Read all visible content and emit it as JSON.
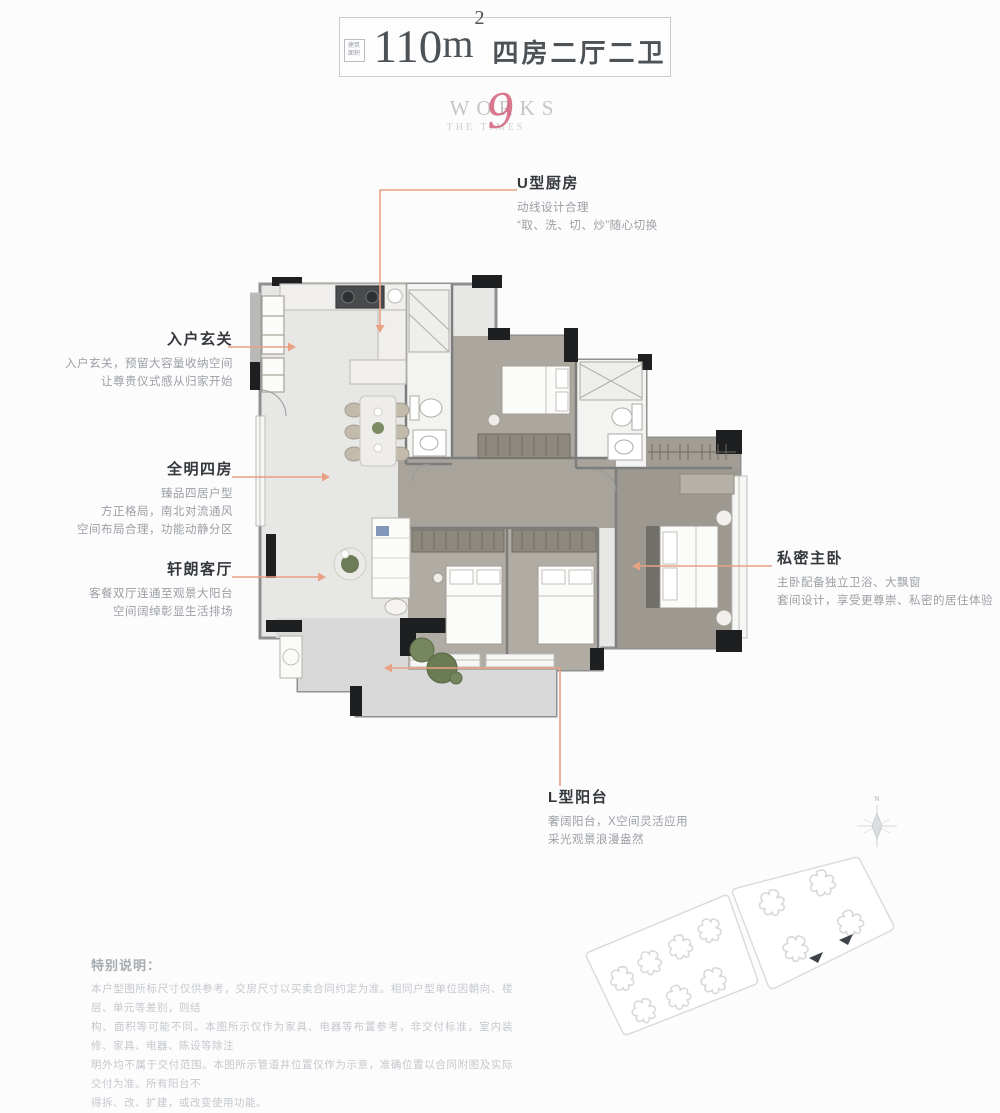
{
  "palette": {
    "leader_accent": "#e8a184",
    "logo_accent": "#d2637c",
    "title_text": "#4d5257",
    "label_title": "#34383c",
    "label_body": "#9b9fa4",
    "wall_dark": "#1e1f20",
    "floor_main": "#e7e7e6",
    "floor_wood": "#a8a49b",
    "note_text": "#c4c8cc"
  },
  "header": {
    "stamp_line1": "建筑",
    "stamp_line2": "面积",
    "area_value": "110",
    "area_unit": "m",
    "area_sup": "2",
    "layout_text": "四房二厅二卫"
  },
  "logo": {
    "line1": "WORKS",
    "script": "9",
    "line2": "THE TIMES"
  },
  "callouts": [
    {
      "id": "u-kitchen",
      "title": "U型厨房",
      "lines": [
        "动线设计合理",
        "“取、洗、切、炒”随心切换"
      ]
    },
    {
      "id": "entry-foyer",
      "title": "入户玄关",
      "lines": [
        "入户玄关，预留大容量收纳空间",
        "让尊贵仪式感从归家开始"
      ]
    },
    {
      "id": "bright-four-rooms",
      "title": "全明四房",
      "lines": [
        "臻品四居户型",
        "方正格局，南北对流通风",
        "空间布局合理，功能动静分区"
      ]
    },
    {
      "id": "living-room",
      "title": "轩朗客厅",
      "lines": [
        "客餐双厅连通至观景大阳台",
        "空间阔绰彰显生活排场"
      ]
    },
    {
      "id": "master-bedroom",
      "title": "私密主卧",
      "lines": [
        "主卧配备独立卫浴、大飘窗",
        "套间设计，享受更尊崇、私密的居住体验"
      ]
    },
    {
      "id": "l-balcony",
      "title": "L型阳台",
      "lines": [
        "奢阔阳台，X空间灵活应用",
        "采光观景浪漫盎然"
      ]
    }
  ],
  "notes": {
    "title": "特别说明：",
    "lines": [
      "本户型图所标尺寸仅供参考，交房尺寸以买卖合同约定为准。相同户型单位因朝向、楼层、单元等差别，则结",
      "构、面积等可能不同。本图所示仅作为家具、电器等布置参考，非交付标准，室内装修、家具、电器、陈设等除注",
      "明外均不属于交付范围。本图所示管道井位置仅作为示意，准确位置以合同附图及实际交付为准。所有阳台不",
      "得拆、改、扩建，或改变使用功能。"
    ]
  },
  "compass": {
    "north_label": "N"
  }
}
